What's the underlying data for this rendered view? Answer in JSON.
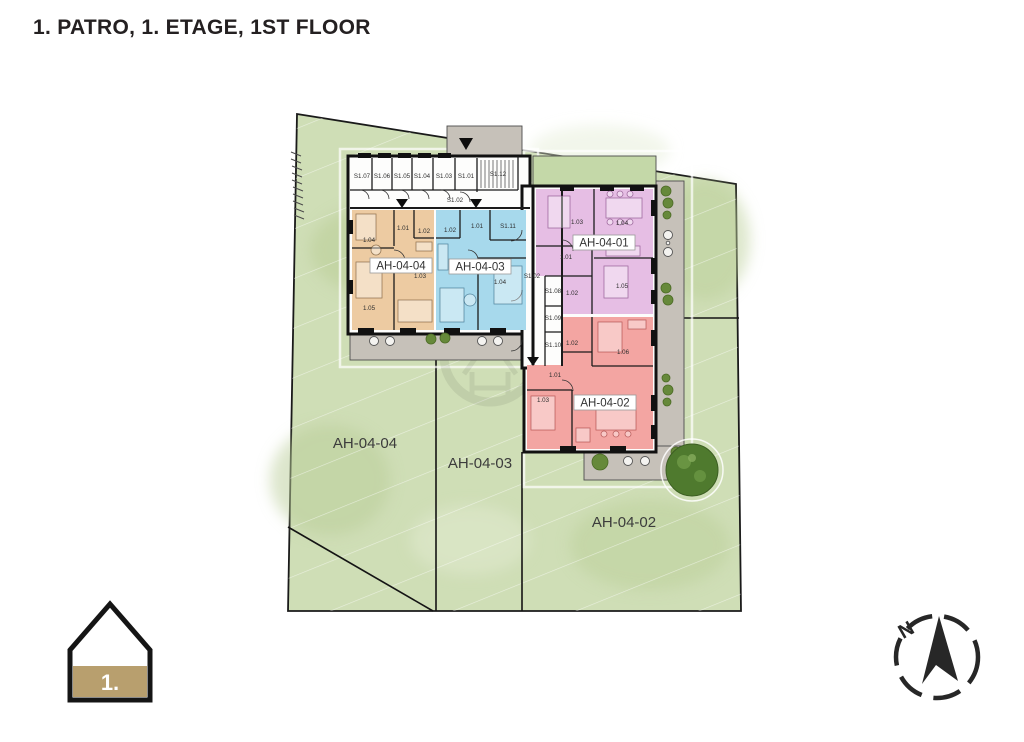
{
  "title": "1. PATRO, 1. ETAGE, 1ST FLOOR",
  "site": {
    "grass_color": "#cfdeb6",
    "terrace_color": "#c6c1b9",
    "plots": {
      "ah0401": "AH-04-01",
      "ah0404": "AH-04-04",
      "ah0403": "AH-04-03",
      "ah0402": "AH-04-02"
    }
  },
  "apartments": {
    "a04": {
      "code": "AH-04-04",
      "color": "#edcba2",
      "rooms": {
        "r104": "1.04",
        "r101": "1.01",
        "r102": "1.02",
        "r103": "1.03",
        "r105": "1.05"
      }
    },
    "a03": {
      "code": "AH-04-03",
      "color": "#a7d9ec",
      "rooms": {
        "r102": "1.02",
        "r101": "1.01",
        "s111": "S1.11",
        "r104": "1.04"
      }
    },
    "a01": {
      "code": "AH-04-01",
      "color": "#e6bee4",
      "rooms": {
        "r103": "1.03",
        "r104": "1.04",
        "r101": "1.01",
        "r102": "1.02",
        "r105": "1.05"
      }
    },
    "a02": {
      "code": "AH-04-02",
      "color": "#f3a5a2",
      "rooms": {
        "r102": "1.02",
        "r106": "1.06",
        "r101": "1.01",
        "r103": "1.03"
      }
    }
  },
  "common": {
    "s107": "S1.07",
    "s106": "S1.06",
    "s105": "S1.05",
    "s104": "S1.04",
    "s103": "S1.03",
    "s101": "S1.01",
    "s112": "S1.12",
    "s102_top": "S1.02",
    "s102_mid": "S1.02",
    "s108": "S1.08",
    "s109": "S1.09",
    "s110": "S1.10"
  },
  "legend": {
    "floor_number": "1.",
    "house_fill": "#b89f6e"
  },
  "compass": {
    "north": "N"
  }
}
